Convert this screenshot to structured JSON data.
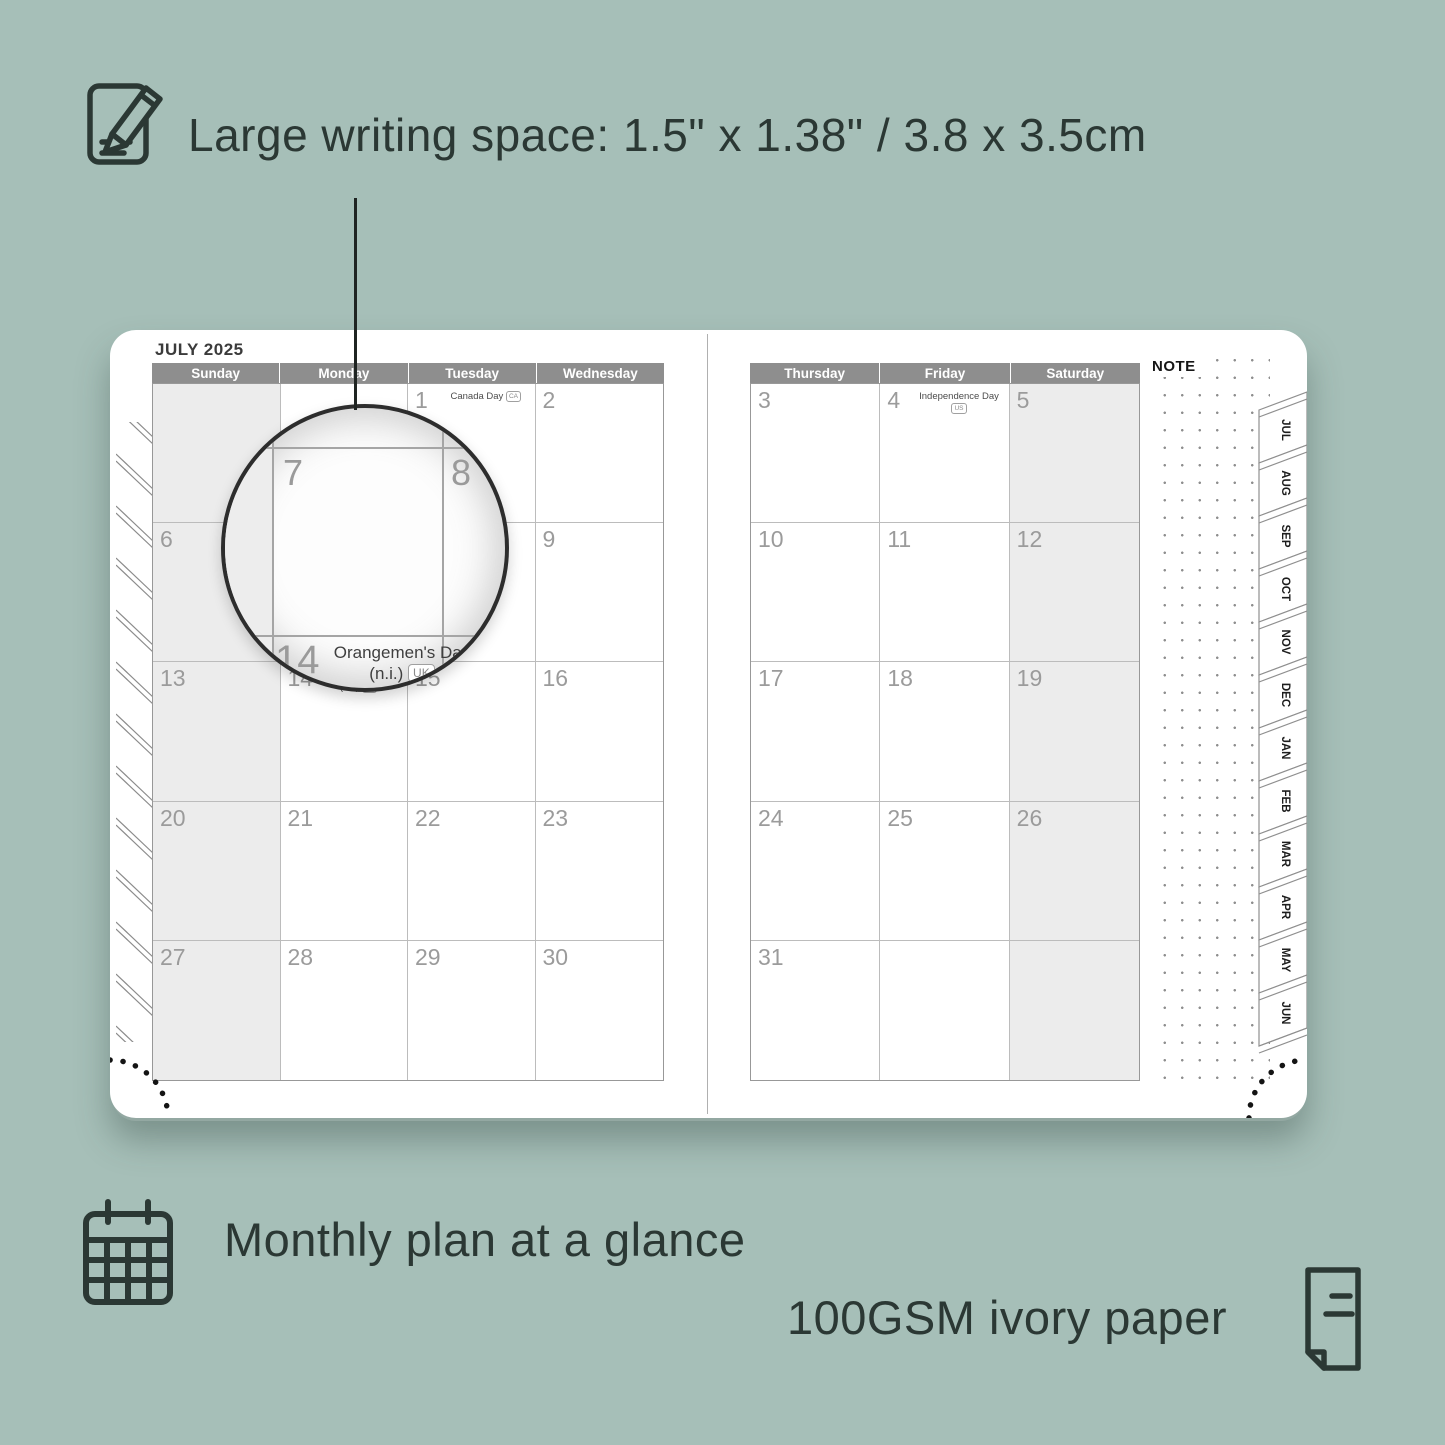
{
  "colors": {
    "background": "#a6bfb8",
    "ink": "#2b3834",
    "header_gray": "#8e8e8e",
    "shaded_column": "#ececec",
    "date_number": "#9b9b9b"
  },
  "captions": {
    "writing_space": "Large writing space: 1.5\" x 1.38\" / 3.8 x 3.5cm",
    "monthly_plan": "Monthly plan at a glance",
    "paper": "100GSM ivory paper"
  },
  "planner": {
    "month_title": "JULY 2025",
    "note_label": "NOTE",
    "month_tabs": [
      "JUL",
      "AUG",
      "SEP",
      "OCT",
      "NOV",
      "DEC",
      "JAN",
      "FEB",
      "MAR",
      "APR",
      "MAY",
      "JUN"
    ],
    "left_page": {
      "day_headers": [
        "Sunday",
        "Monday",
        "Tuesday",
        "Wednesday"
      ],
      "weeks": [
        [
          {
            "date": ""
          },
          {
            "date": ""
          },
          {
            "date": "1",
            "holiday": "Canada Day",
            "badge": "CA"
          },
          {
            "date": "2"
          }
        ],
        [
          {
            "date": "6"
          },
          {
            "date": "7"
          },
          {
            "date": "8"
          },
          {
            "date": "9"
          }
        ],
        [
          {
            "date": "13"
          },
          {
            "date": "14",
            "holiday": "Orangemen's Day (n.i.)",
            "badge": "UK"
          },
          {
            "date": "15"
          },
          {
            "date": "16"
          }
        ],
        [
          {
            "date": "20"
          },
          {
            "date": "21"
          },
          {
            "date": "22"
          },
          {
            "date": "23"
          }
        ],
        [
          {
            "date": "27"
          },
          {
            "date": "28"
          },
          {
            "date": "29"
          },
          {
            "date": "30"
          }
        ]
      ]
    },
    "right_page": {
      "day_headers": [
        "Thursday",
        "Friday",
        "Saturday"
      ],
      "weeks": [
        [
          {
            "date": "3"
          },
          {
            "date": "4",
            "holiday": "Independence Day",
            "badge": "US"
          },
          {
            "date": "5"
          }
        ],
        [
          {
            "date": "10"
          },
          {
            "date": "11"
          },
          {
            "date": "12"
          }
        ],
        [
          {
            "date": "17"
          },
          {
            "date": "18"
          },
          {
            "date": "19"
          }
        ],
        [
          {
            "date": "24"
          },
          {
            "date": "25"
          },
          {
            "date": "26"
          }
        ],
        [
          {
            "date": "31"
          },
          {
            "date": ""
          },
          {
            "date": ""
          }
        ]
      ]
    },
    "magnifier": {
      "day_main": "7",
      "day_right": "8",
      "day_bottom": "14",
      "holiday": "Orangemen's Day",
      "holiday_suffix": "(n.i.)",
      "badge": "UK"
    }
  }
}
